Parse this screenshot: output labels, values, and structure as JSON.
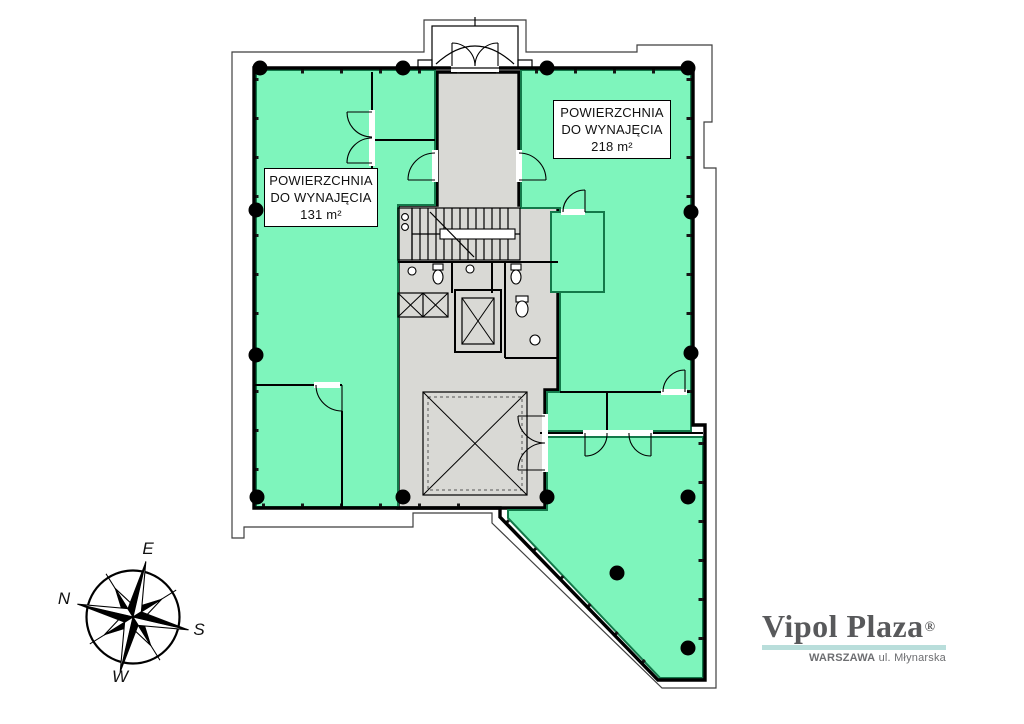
{
  "colors": {
    "plan_green": "#7ef5bc",
    "plan_green_dark": "#13794a",
    "core_gray": "#d9d9d5",
    "wall_black": "#000000",
    "outline_gray": "#3f3f3f",
    "logo_text": "#58595b",
    "logo_underline": "#b9dedb",
    "logo_subtext": "#6d6e71"
  },
  "area_labels": {
    "right": {
      "line1": "POWIERZCHNIA",
      "line2": "DO WYNAJĘCIA",
      "line3": "218 m²"
    },
    "left": {
      "line1": "POWIERZCHNIA",
      "line2": "DO WYNAJĘCIA",
      "line3": "131 m²"
    }
  },
  "compass": {
    "top": "E",
    "left": "N",
    "right": "S",
    "bottom": "W"
  },
  "logo": {
    "name": "Vipol Plaza",
    "registered": "®",
    "subtitle_bold": "WARSZAWA",
    "subtitle_rest": "ul. Młynarska"
  }
}
